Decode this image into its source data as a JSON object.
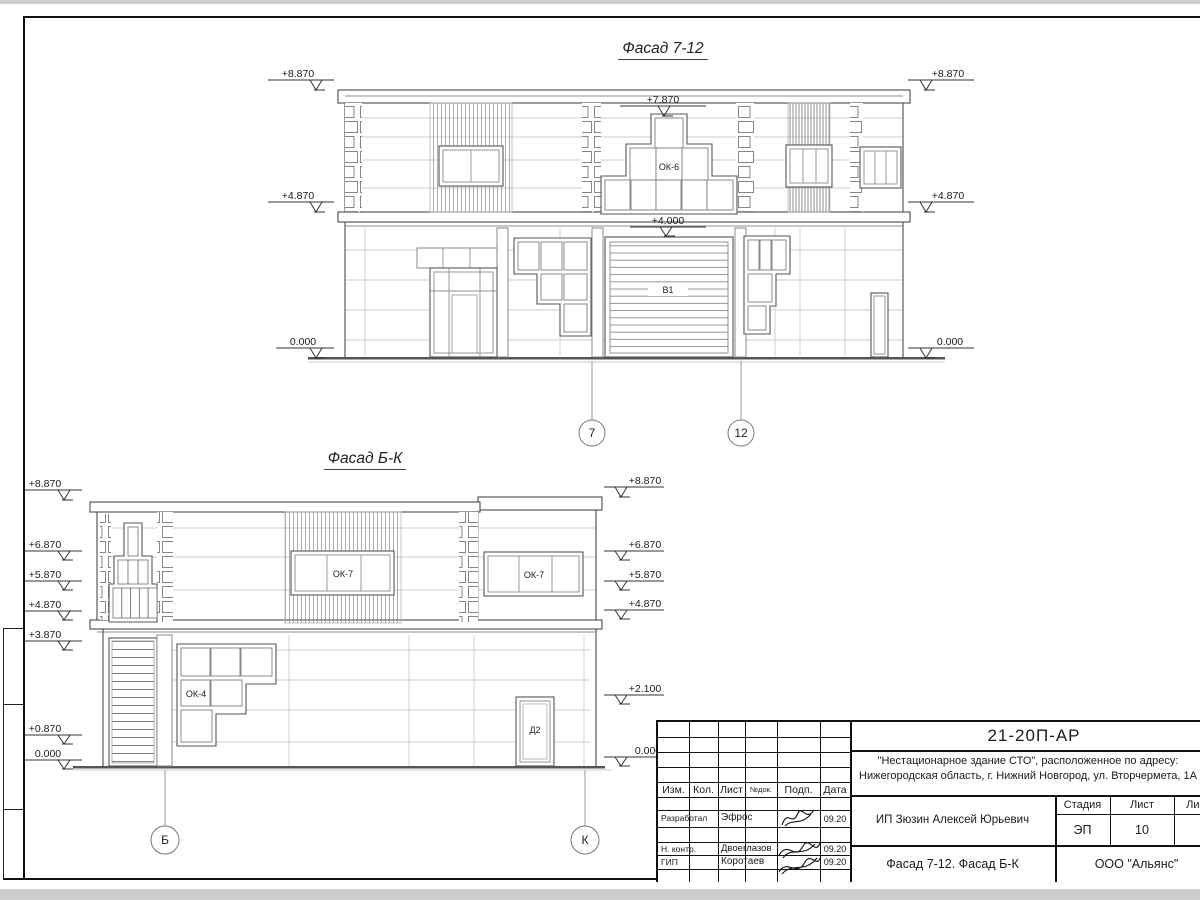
{
  "f712": {
    "title": "Фасад 7-12",
    "elevLeft": [
      "+8.870",
      "+4.870",
      "0.000"
    ],
    "elevRight": [
      "+8.870",
      "+4.870",
      "0.000"
    ],
    "lvl_top": "+7.870",
    "lvl_gate": "+4.000",
    "win_label": "ОК-6",
    "gate_label": "В1",
    "axes": [
      "7",
      "12"
    ]
  },
  "fbk": {
    "title": "Фасад Б-К",
    "elevLeft": [
      "+8.870",
      "+6.870",
      "+5.870",
      "+4.870",
      "+3.870",
      "+0.870",
      "0.000"
    ],
    "elevRight": [
      "+8.870",
      "+6.870",
      "+5.870",
      "+4.870",
      "+2.100",
      "0.000"
    ],
    "win_left": "ОК-7",
    "win_right": "ОК-7",
    "win_ok4": "ОК-4",
    "door": "Д2",
    "axes": [
      "Б",
      "К"
    ]
  },
  "titleblock": {
    "doc_number": "21-20П-АР",
    "project_line1": "\"Нестационарное здание СТО\", расположенное по адресу:",
    "project_line2": "Нижегородская область, г. Нижний Новгород, ул. Вторчермета, 1А",
    "cols": [
      "Изм.",
      "Кол.",
      "Лист",
      "№док.",
      "Подп.",
      "Дата"
    ],
    "rows": [
      {
        "role": "Разработал",
        "name": "Эфрос",
        "date": "09.20"
      },
      {
        "role": "Н. контр.",
        "name": "Двоеглазов",
        "date": "09.20"
      },
      {
        "role": "ГИП",
        "name": "Коротаев",
        "date": "09.20"
      }
    ],
    "client": "ИП Зюзин Алексей Юрьевич",
    "stage_cols": [
      "Стадия",
      "Лист",
      "Листов"
    ],
    "stage": "ЭП",
    "sheet_no": "10",
    "sheet_title": "Фасад 7-12. Фасад Б-К",
    "company": "ООО \"Альянс\""
  }
}
